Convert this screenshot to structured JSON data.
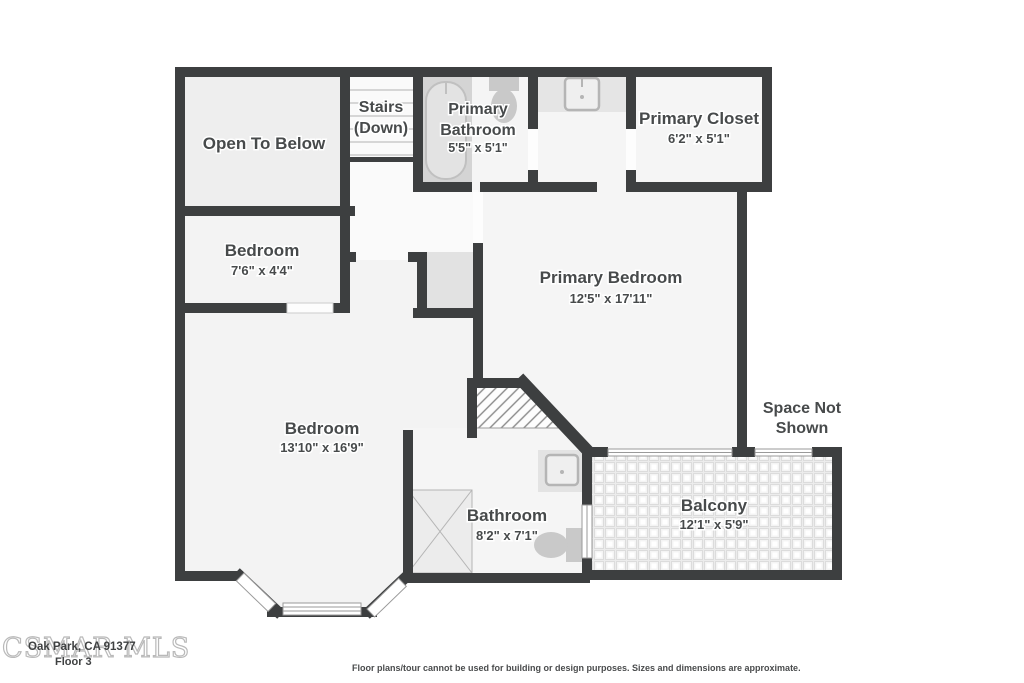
{
  "rooms": {
    "open_to_below": {
      "label": "Open To Below"
    },
    "stairs": {
      "label_line1": "Stairs",
      "label_line2": "(Down)"
    },
    "primary_bathroom": {
      "label_line1": "Primary",
      "label_line2": "Bathroom",
      "dims": "5'5\" x 5'1\""
    },
    "primary_closet": {
      "label": "Primary Closet",
      "dims": "6'2\" x 5'1\""
    },
    "bedroom_small": {
      "label": "Bedroom",
      "dims": "7'6\" x 4'4\""
    },
    "primary_bedroom": {
      "label": "Primary Bedroom",
      "dims": "12'5\" x 17'11\""
    },
    "bedroom_large": {
      "label": "Bedroom",
      "dims": "13'10\" x 16'9\""
    },
    "bathroom": {
      "label": "Bathroom",
      "dims": "8'2\" x 7'1\""
    },
    "balcony": {
      "label": "Balcony",
      "dims": "12'1\" x 5'9\""
    },
    "space_not_shown": {
      "label_line1": "Space Not",
      "label_line2": "Shown"
    }
  },
  "footer": {
    "watermark": "CSMAR MLS",
    "address": "Oak Park, CA 91377",
    "floor_label": "Floor 3",
    "disclaimer": "Floor plans/tour cannot be used for building or design purposes. Sizes and dimensions are approximate."
  },
  "colors": {
    "wall": "#3d3f40",
    "room_fill": "#f5f5f5",
    "closet_fill": "#e2e2e2",
    "fixture": "#c9c9c9",
    "label_text": "#474a4b"
  }
}
